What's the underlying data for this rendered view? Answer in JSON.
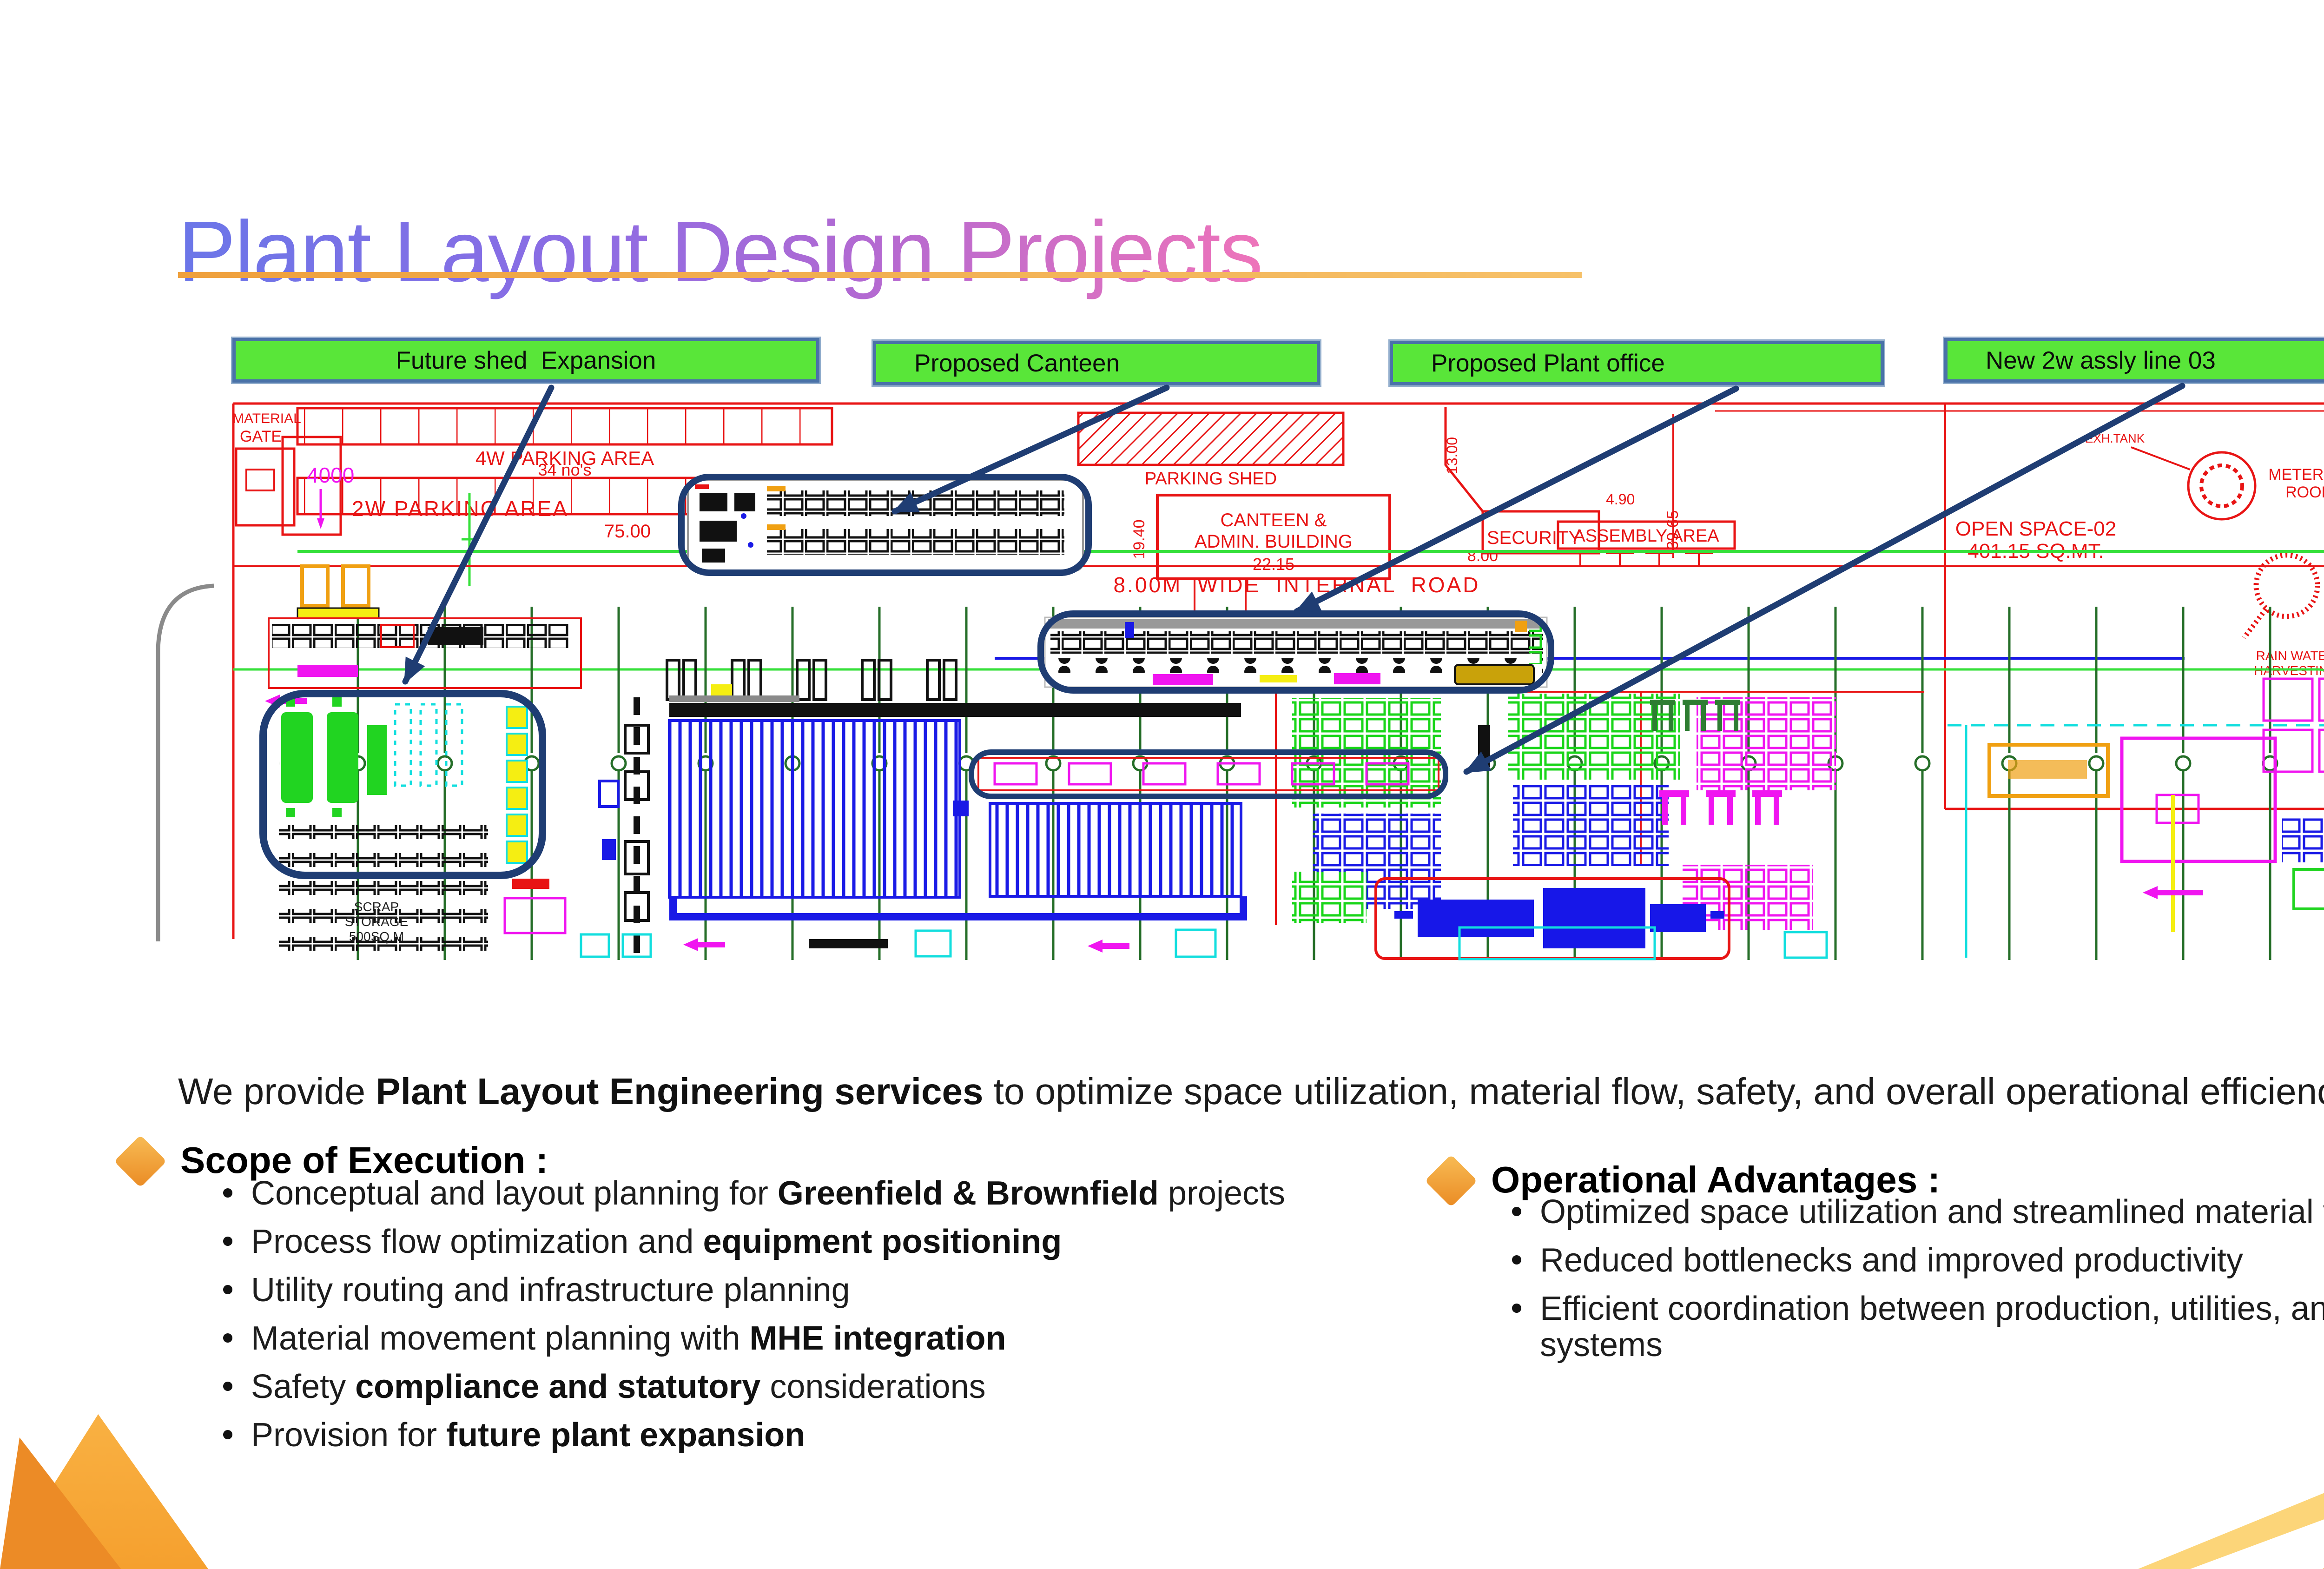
{
  "slide": {
    "title": "Plant Layout Design Projects",
    "intro": {
      "pre": "We provide ",
      "bold": "Plant Layout Engineering services",
      "post": " to optimize space utilization, material flow, safety, and overall operational efficiency."
    }
  },
  "logo": {
    "v": "V",
    "ps": "PS"
  },
  "callouts": {
    "items": [
      {
        "label": "Future shed  Expansion"
      },
      {
        "label": "Proposed Canteen"
      },
      {
        "label": "Proposed Plant office"
      },
      {
        "label": "New 2w assly line 03"
      }
    ]
  },
  "scope": {
    "heading": "Scope of Execution :",
    "bullets": [
      {
        "pre": "Conceptual and layout planning for ",
        "bold": "Greenfield & Brownfield",
        "post": " projects"
      },
      {
        "pre": "Process flow optimization and ",
        "bold": "equipment positioning",
        "post": ""
      },
      {
        "pre": "Utility routing and infrastructure planning",
        "bold": "",
        "post": ""
      },
      {
        "pre": "Material movement planning with ",
        "bold": "MHE integration",
        "post": ""
      },
      {
        "pre": "Safety ",
        "bold": "compliance and statutory",
        "post": " considerations"
      },
      {
        "pre": "Provision for ",
        "bold": "future plant expansion",
        "post": ""
      }
    ]
  },
  "advantages": {
    "heading": "Operational Advantages :",
    "bullets": [
      {
        "text": "Optimized space utilization and streamlined material flow"
      },
      {
        "text": "Reduced bottlenecks and improved productivity"
      },
      {
        "text": "Efficient coordination between production, utilities, and support systems"
      }
    ]
  },
  "diagram": {
    "labels": {
      "material": "MATERIAL",
      "gate": "GATE",
      "dim4000": "4000",
      "parking4w": "4W PARKING AREA",
      "parking4w_count": "34 no's",
      "dim7500": "75.00",
      "parking2w": "2W PARKING AREA",
      "parking_shed": "PARKING SHED",
      "canteen1": "CANTEEN &",
      "canteen2": "ADMIN. BUILDING",
      "dim1940": "19.40",
      "dim2215": "22.15",
      "security": "SECURITY",
      "dim1300": "13.00",
      "dim490": "4.90",
      "dim800": "8.00",
      "dim3965": "39.65",
      "assembly": "ASSEMBLY AREA",
      "road": "8.00M WIDE INTERNAL ROAD",
      "open_space1": "OPEN SPACE-02",
      "open_space2": "401.15 SQ.MT.",
      "exh_tank": "EXH.TANK",
      "metering1": "METERING",
      "metering2": "ROOM",
      "rain1": "RAIN WATER",
      "rain2": "HARVESTING",
      "scrap1": "SCRAP",
      "scrap2": "STORAGE",
      "scrap3": "500SQ.M"
    }
  },
  "colors": {
    "callout_green": "#59e639",
    "callout_border": "#4a72a8",
    "highlight_navy": "#1f3d73",
    "underline_orange": "#efa03c",
    "cad_red": "#e81414",
    "cad_green_col": "#256e28",
    "title_gradient_start": "#6b76e8",
    "title_gradient_end": "#ee74ba"
  }
}
